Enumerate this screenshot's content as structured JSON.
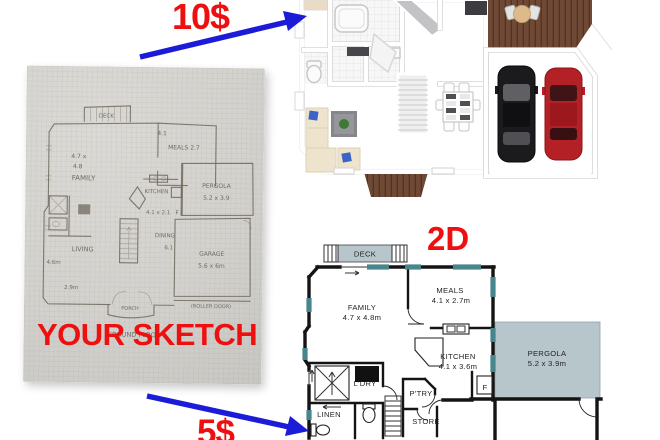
{
  "annotations": {
    "price_3d": "10$",
    "price_2d": "5$",
    "sketch_caption": "YOUR SKETCH",
    "plan_caption": "2D"
  },
  "colors": {
    "accent_red": "#ee1010",
    "arrow_blue": "#1c1cd8",
    "pergola_fill": "#b7c6cb",
    "window_teal": "#47868c",
    "wood_floor": "#e4d5b6",
    "deck_brown": "#6d4936",
    "garage_floor": "#c9c9cd",
    "car_black": "#1b1b1d",
    "car_red": "#b32025"
  },
  "sketch_labels": {
    "deck": "DECK",
    "meals_w": "4.1",
    "meals": "MEALS 2.7",
    "family_d1": "4.7 x",
    "family_d2": "4.8",
    "family": "FAMILY",
    "pergola": "PERGOLA",
    "pergola_dims": "5.2 x 3.9",
    "kitchen": "KITCHEN",
    "kitchen_dims": "4.1 x 2.1",
    "kitchen_f": "F",
    "dining": "DINING",
    "dining_d": "6.1",
    "garage": "GARAGE",
    "garage_dims": "5.6 x 6m",
    "living": "LIVING",
    "living_w": "4.6m",
    "living_d": "2.9m",
    "porch": "PORCH",
    "roller_door": "(ROLLER DOOR)",
    "ground_floor": "GROUND FLOOR"
  },
  "plan2d": {
    "rooms": [
      {
        "name": "DECK",
        "dims": ""
      },
      {
        "name": "FAMILY",
        "dims": "4.7 x 4.8m"
      },
      {
        "name": "MEALS",
        "dims": "4.1 x 2.7m"
      },
      {
        "name": "KITCHEN",
        "dims": "4.1 x 3.6m"
      },
      {
        "name": "PERGOLA",
        "dims": "5.2 x 3.9m"
      },
      {
        "name": "L'DRY",
        "dims": ""
      },
      {
        "name": "LINEN",
        "dims": ""
      },
      {
        "name": "P'TRY",
        "dims": ""
      },
      {
        "name": "STORE",
        "dims": ""
      },
      {
        "name": "F",
        "dims": ""
      }
    ]
  }
}
